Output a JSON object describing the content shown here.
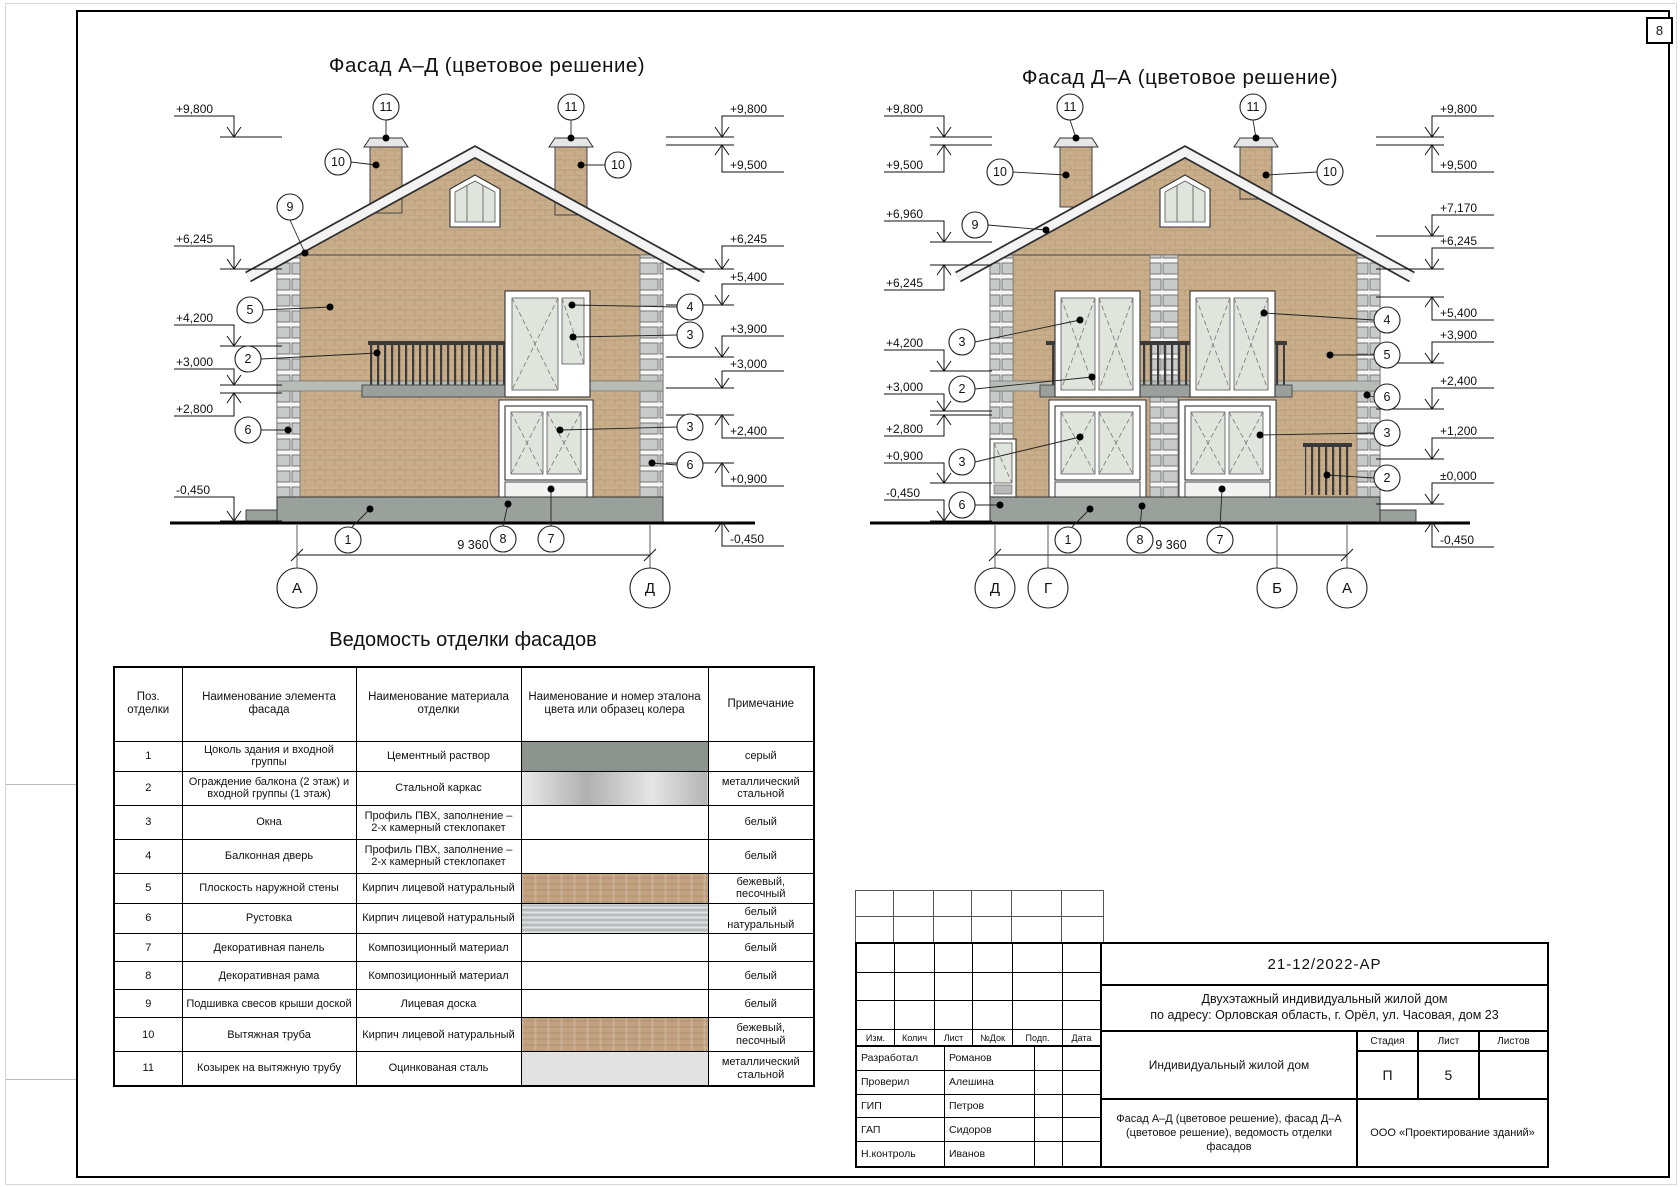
{
  "page": {
    "sheet_number": "8"
  },
  "callout_numbers": {
    "n1": "1",
    "n2": "2",
    "n3": "3",
    "n4": "4",
    "n5": "5",
    "n6": "6",
    "n7": "7",
    "n8": "8",
    "n9": "9",
    "n10": "10",
    "n11": "11"
  },
  "facade_left": {
    "title": "Фасад А–Д (цветовое решение)",
    "dimension": "9 360",
    "axis_left": "А",
    "axis_right": "Д",
    "marks_left": [
      "+9,800",
      "+6,245",
      "+4,200",
      "+3,000",
      "+2,800",
      "-0,450"
    ],
    "marks_right": [
      "+9,800",
      "+9,500",
      "+6,245",
      "+5,400",
      "+3,900",
      "+3,000",
      "+2,400",
      "+0,900",
      "-0,450"
    ]
  },
  "facade_right": {
    "title": "Фасад Д–А (цветовое решение)",
    "dimension": "9 360",
    "axes": [
      "Д",
      "Г",
      "Б",
      "А"
    ],
    "marks_left": [
      "+9,800",
      "+9,500",
      "+6,960",
      "+6,245",
      "+4,200",
      "+3,000",
      "+2,800",
      "+0,900",
      "-0,450"
    ],
    "marks_right": [
      "+9,800",
      "+9,500",
      "+7,170",
      "+6,245",
      "+5,400",
      "+3,900",
      "+2,400",
      "+1,200",
      "±0,000",
      "-0,450"
    ]
  },
  "finish_table": {
    "title": "Ведомость отделки фасадов",
    "headers": [
      "Поз. отделки",
      "Наименование элемента фасада",
      "Наименование материала отделки",
      "Наименование и номер эталона цвета или образец колера",
      "Примечание"
    ],
    "rows": [
      {
        "pos": "1",
        "element": "Цоколь здания и входной группы",
        "material": "Цементный раствор",
        "swatch": "#8d938d",
        "note": "серый"
      },
      {
        "pos": "2",
        "element": "Ограждение балкона (2 этаж) и входной группы (1 этаж)",
        "material": "Стальной каркас",
        "swatch": "#c6c6c6",
        "note": "металлический стальной"
      },
      {
        "pos": "3",
        "element": "Окна",
        "material": "Профиль ПВХ, заполнение – 2-х камерный стеклопакет",
        "swatch": "",
        "note": "белый"
      },
      {
        "pos": "4",
        "element": "Балконная дверь",
        "material": "Профиль ПВХ, заполнение – 2-х камерный стеклопакет",
        "swatch": "",
        "note": "белый"
      },
      {
        "pos": "5",
        "element": "Плоскость наружной стены",
        "material": "Кирпич лицевой натуральный",
        "swatch": "#c1a180",
        "note": "бежевый, песочный"
      },
      {
        "pos": "6",
        "element": "Рустовка",
        "material": "Кирпич лицевой натуральный",
        "swatch": "#b7bbbc",
        "note": "белый натуральный"
      },
      {
        "pos": "7",
        "element": "Декоративная панель",
        "material": "Композиционный материал",
        "swatch": "",
        "note": "белый"
      },
      {
        "pos": "8",
        "element": "Декоративная рама",
        "material": "Композиционный материал",
        "swatch": "",
        "note": "белый"
      },
      {
        "pos": "9",
        "element": "Подшивка свесов крыши доской",
        "material": "Лицевая доска",
        "swatch": "",
        "note": "белый"
      },
      {
        "pos": "10",
        "element": "Вытяжная труба",
        "material": "Кирпич лицевой натуральный",
        "swatch": "#c1a180",
        "note": "бежевый, песочный"
      },
      {
        "pos": "11",
        "element": "Козырек на вытяжную трубу",
        "material": "Оцинкованая сталь",
        "swatch": "#e2e2e2",
        "note": "металлический стальной"
      }
    ]
  },
  "title_block": {
    "doc_number": "21-12/2022-АР",
    "project_line1": "Двухэтажный индивидуальный жилой дом",
    "project_line2": "по адресу: Орловская область, г. Орёл, ул. Часовая, дом 23",
    "object_name": "Индивидуальный жилой дом",
    "sheet_content": "Фасад А–Д (цветовое решение), фасад Д–А (цветовое решение), ведомость отделки фасадов",
    "company": "ООО «Проектирование зданий»",
    "stage_label": "Стадия",
    "sheet_label": "Лист",
    "sheets_label": "Листов",
    "stage_value": "П",
    "sheet_value": "5",
    "sheets_value": "",
    "columns": [
      "Изм.",
      "Колич",
      "Лист",
      "№Док",
      "Подп.",
      "Дата"
    ],
    "signatures": [
      {
        "role": "Разработал",
        "name": "Романов"
      },
      {
        "role": "Проверил",
        "name": "Алешина"
      },
      {
        "role": "ГИП",
        "name": "Петров"
      },
      {
        "role": "ГАП",
        "name": "Сидоров"
      },
      {
        "role": "Н.контроль",
        "name": "Иванов"
      }
    ]
  }
}
